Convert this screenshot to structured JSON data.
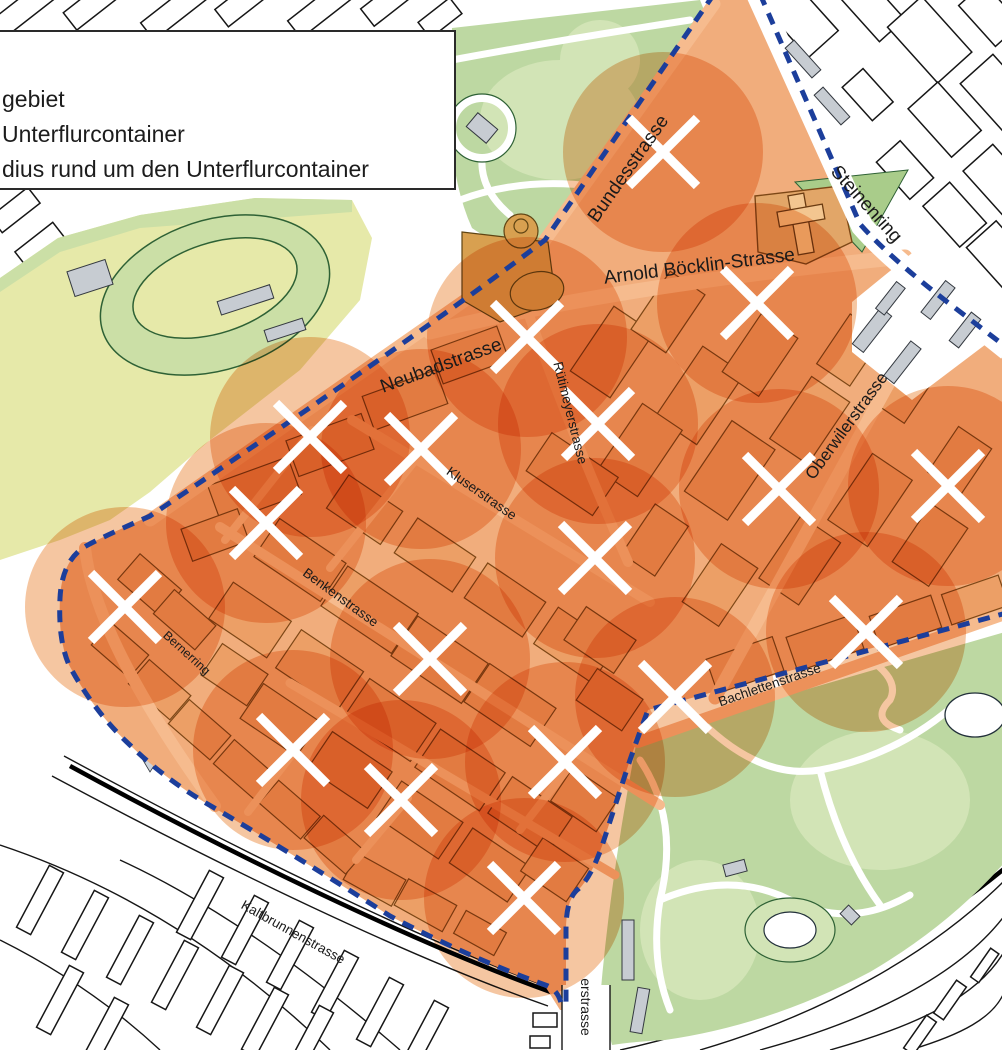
{
  "legend": {
    "lines": [
      "gebiet",
      "Unterflurcontainer",
      "dius rund um den Unterflurcontainer"
    ]
  },
  "map": {
    "street_labels": [
      {
        "id": "bundesstrasse",
        "text": "Bundesstrasse",
        "x": 633,
        "y": 172,
        "rot": -55,
        "size": 19
      },
      {
        "id": "steinenring",
        "text": "Steinenring",
        "x": 862,
        "y": 208,
        "rot": 48,
        "size": 19
      },
      {
        "id": "arnold-boecklin-strasse",
        "text": "Arnold Böcklin-Strasse",
        "x": 700,
        "y": 272,
        "rot": -7,
        "size": 19
      },
      {
        "id": "neubadstrasse",
        "text": "Neubadstrasse",
        "x": 443,
        "y": 371,
        "rot": -20,
        "size": 19
      },
      {
        "id": "ruetimeyerstrasse",
        "text": "Rütimeyerstrasse",
        "x": 566,
        "y": 414,
        "rot": 76,
        "size": 13.5
      },
      {
        "id": "oberwilerstrasse",
        "text": "Oberwilerstrasse",
        "x": 851,
        "y": 429,
        "rot": -54,
        "size": 17
      },
      {
        "id": "kluserstrasse",
        "text": "Kluserstrasse",
        "x": 479,
        "y": 497,
        "rot": 35,
        "size": 13.5
      },
      {
        "id": "benkenstrasse",
        "text": "Benkenstrasse",
        "x": 338,
        "y": 601,
        "rot": 36,
        "size": 13.5
      },
      {
        "id": "bernerring",
        "text": "Bernerring",
        "x": 184,
        "y": 656,
        "rot": 42,
        "size": 12.5
      },
      {
        "id": "bachlettenstrasse",
        "text": "Bachlettenstrasse",
        "x": 771,
        "y": 689,
        "rot": -19,
        "size": 13.5
      },
      {
        "id": "kaltbrunnenstrasse",
        "text": "Kaltbrunnenstrasse",
        "x": 291,
        "y": 936,
        "rot": 29,
        "size": 13.5
      },
      {
        "id": "erstrasse",
        "text": "erstrasse",
        "x": 581,
        "y": 1007,
        "rot": 90,
        "size": 14
      }
    ],
    "containers": {
      "symbol": "x-cross",
      "radius_px": 100,
      "points": [
        [
          663,
          152
        ],
        [
          527,
          337
        ],
        [
          757,
          303
        ],
        [
          598,
          424
        ],
        [
          310,
          437
        ],
        [
          421,
          449
        ],
        [
          266,
          523
        ],
        [
          779,
          489
        ],
        [
          948,
          486
        ],
        [
          595,
          558
        ],
        [
          125,
          607
        ],
        [
          866,
          632
        ],
        [
          430,
          659
        ],
        [
          675,
          697
        ],
        [
          293,
          750
        ],
        [
          565,
          762
        ],
        [
          401,
          800
        ],
        [
          524,
          898
        ]
      ]
    },
    "colors": {
      "pilot_base": "#f1ad7c",
      "street": "#f6bb8e",
      "building": "#ec9f66",
      "building_outline": "#7d4716",
      "circle": "#e87820",
      "boundary": "#1c3e9b",
      "cross": "#ffffff",
      "park": "#bdd8a2",
      "park_light": "#d2e4b6",
      "field": "#e6e9a9",
      "field_band": "#cbdfa6",
      "gray_building": "#c7ccd2",
      "tan": "#d8a050"
    }
  }
}
